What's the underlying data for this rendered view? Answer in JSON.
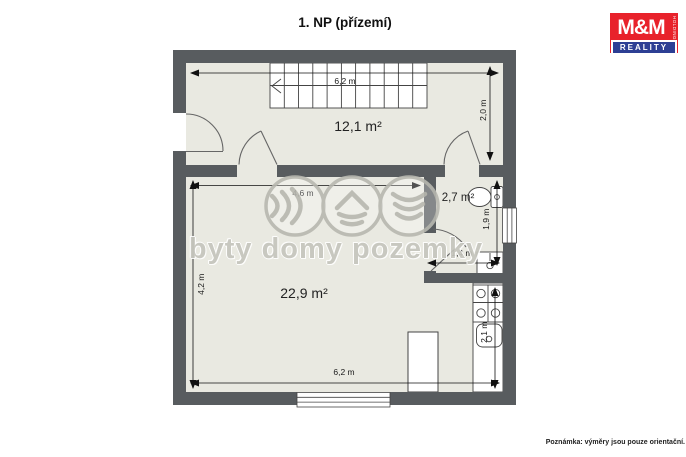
{
  "title": "1. NP (přízemí)",
  "note": "Poznámka: výměry jsou pouze orientační.",
  "watermark": "byty domy pozemky",
  "logo": {
    "name": "M&M",
    "subtitle": "REALITY",
    "side_text": "HOLDING"
  },
  "rooms": {
    "hall": {
      "area": "12,1 m²"
    },
    "living": {
      "area": "22,9 m²"
    },
    "wc": {
      "area": "2,7 m²"
    }
  },
  "dimensions": {
    "hall_width": "6,2 m",
    "hall_depth": "2,0 m",
    "living_width": "4,6 m",
    "living_depth": "4,2 m",
    "bottom_width": "6,2 m",
    "wc_depth": "1,9 m",
    "wc_width": "1,4 m",
    "kitchen_depth": "2,1 m"
  },
  "colors": {
    "wall": "#585c5f",
    "floor": "#e9e9e1",
    "fixture_line": "#444444",
    "logo_red": "#e8222b",
    "logo_blue": "#2d3f94",
    "watermark_gray": "#c6c6be"
  }
}
